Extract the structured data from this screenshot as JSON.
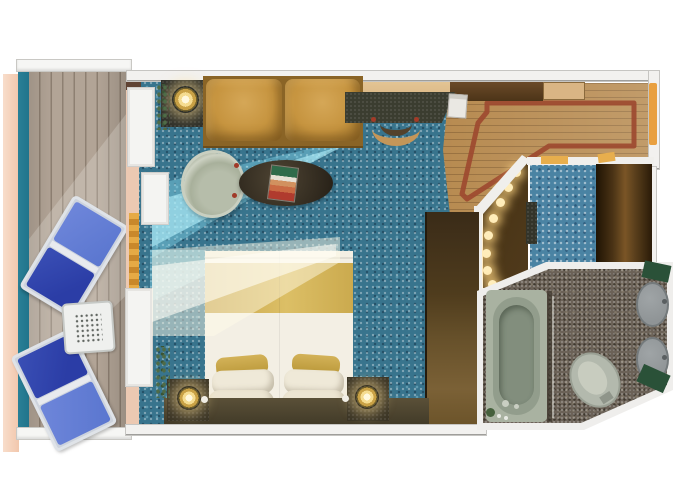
{
  "title": "Cruise ship balcony stateroom floor plan",
  "palette": {
    "carpet": "#38748D",
    "carpet_light": "#4A83A3",
    "wood_floor": "#B6894E",
    "wood_inlay": "#9D4A30",
    "deck": "#B2A496",
    "hull": "#F2C7AC",
    "railing": "#20738A",
    "wall": "#F2F1EF",
    "door_orange": "#E9A040",
    "gold_trim": "#E7AE4D",
    "sofa_leather": "#C6943F",
    "bed_gold": "#C7A348",
    "bed_linen": "#F3EFE4",
    "dark_wood": "#3B3526",
    "closet_brown": "#5A3F1C",
    "lounger_navy": "#2B3DA6",
    "lounger_blue": "#5A76CF",
    "bath_floor": "#6B6257",
    "tub_green": "#A9B2A1",
    "fixture_gray": "#8F9496",
    "mat_green": "#2A5138",
    "lamp_glow": "#FFEDBB",
    "sunlight": "#8CE1F6"
  },
  "rooms": {
    "balcony": {
      "label": "Balcony",
      "furniture": [
        "lounge chair",
        "lounge chair",
        "patio table"
      ]
    },
    "cabin": {
      "label": "Stateroom",
      "furniture": [
        "sofa",
        "coffee table with magazine",
        "armchair",
        "desk",
        "desk stool",
        "bed",
        "nightstand with lamp",
        "nightstand with lamp",
        "wardrobe"
      ]
    },
    "entry": {
      "label": "Entry hall",
      "furniture": [
        "wood floor with inlay border",
        "entry door"
      ]
    },
    "dressing": {
      "label": "Dressing area",
      "furniture": [
        "vanity lights",
        "bench",
        "closet"
      ]
    },
    "bathroom": {
      "label": "Bathroom",
      "furniture": [
        "bathtub",
        "toilet",
        "twin sinks",
        "bath mats"
      ]
    }
  }
}
